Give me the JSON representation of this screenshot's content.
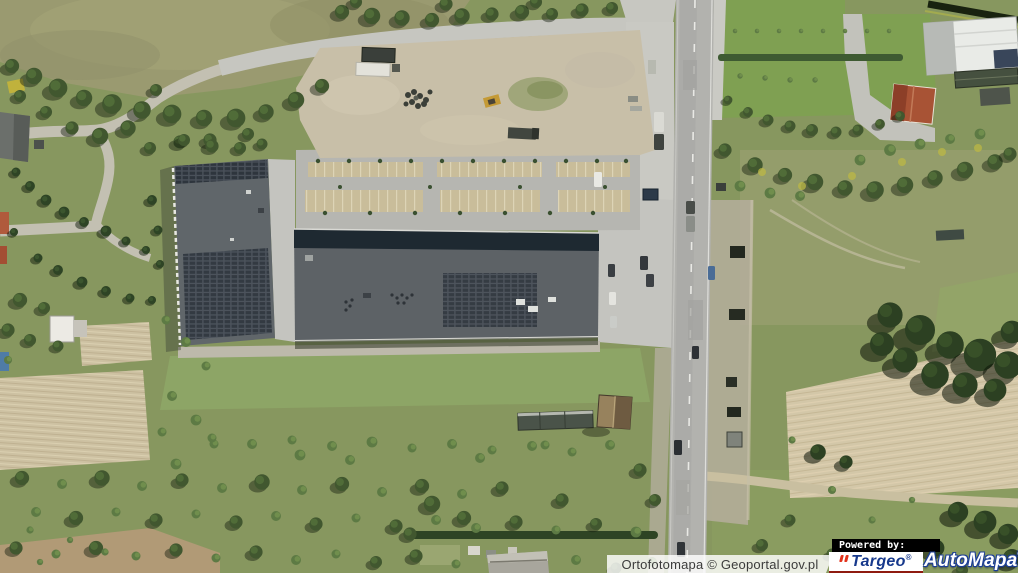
{
  "attribution": {
    "text": "Ortofotomapa © Geoportal.gov.pl"
  },
  "branding": {
    "powered_by_label": "Powered by:",
    "targeo_label": "Targeo",
    "automapa_label": "AutoMapa",
    "registered_mark": "®",
    "targeo_text_color": "#17398c",
    "targeo_accent_color": "#e2331c",
    "targeo_bg_color": "#ffffff",
    "automapa_text_color": "#ffffff",
    "automapa_outline_color": "#1c3e96",
    "powered_by_bg": "#000000",
    "powered_by_text_color": "#ffffff"
  },
  "map": {
    "view": "aerial-orthophoto",
    "features": [
      "retail-building-with-solar-roof",
      "parking-lot",
      "construction-site",
      "main-road-vertical",
      "plowed-fields",
      "tree-cover",
      "red-roof-house",
      "white-industrial-building",
      "meadows-and-scrub"
    ]
  }
}
